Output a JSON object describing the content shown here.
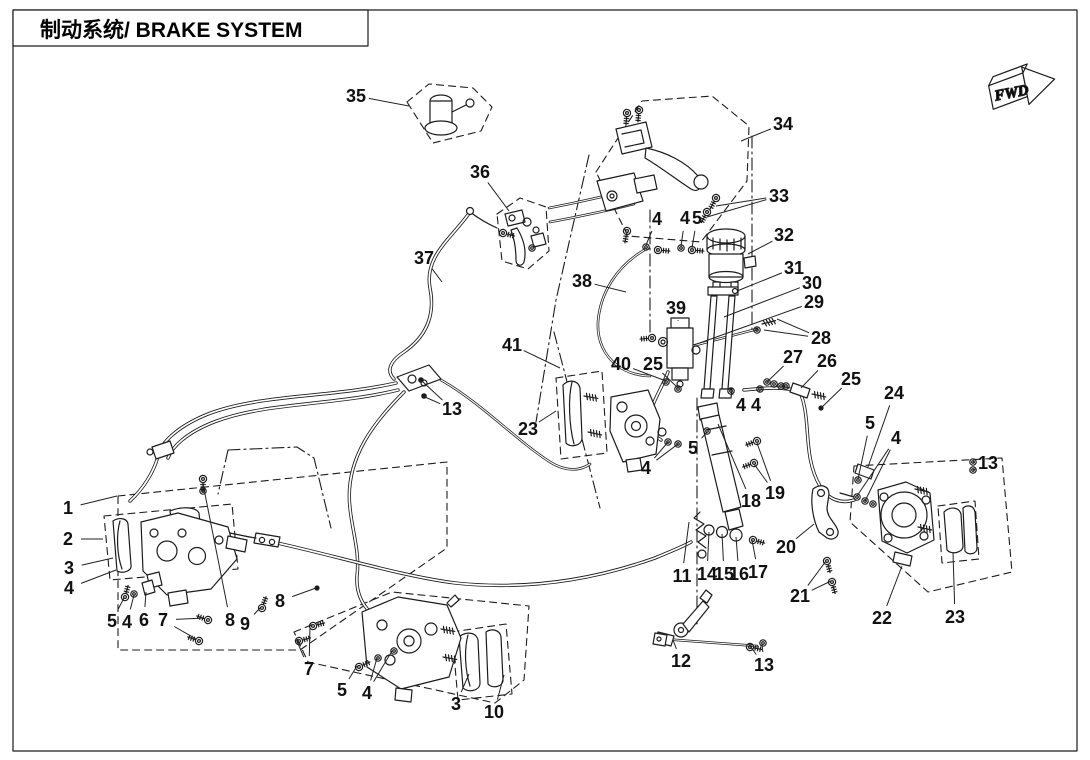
{
  "header": {
    "title": "制动系统/ BRAKE SYSTEM"
  },
  "fwd_marker": {
    "label": "FWD"
  },
  "diagram": {
    "callouts": [
      {
        "n": "35",
        "x": 356,
        "y": 96,
        "l": [
          [
            409,
            106
          ]
        ]
      },
      {
        "n": "36",
        "x": 480,
        "y": 172,
        "l": [
          [
            509,
            211
          ]
        ]
      },
      {
        "n": "37",
        "x": 424,
        "y": 258,
        "l": [
          [
            442,
            282
          ]
        ]
      },
      {
        "n": "34",
        "x": 783,
        "y": 124,
        "l": [
          [
            741,
            141
          ]
        ]
      },
      {
        "n": "33",
        "x": 779,
        "y": 196,
        "l": [
          [
            716,
            206
          ],
          [
            707,
            217
          ]
        ]
      },
      {
        "n": "32",
        "x": 784,
        "y": 235,
        "l": [
          [
            748,
            254
          ]
        ]
      },
      {
        "n": "31",
        "x": 794,
        "y": 268,
        "l": [
          [
            737,
            291
          ]
        ]
      },
      {
        "n": "30",
        "x": 812,
        "y": 283,
        "l": [
          [
            724,
            317
          ]
        ]
      },
      {
        "n": "29",
        "x": 814,
        "y": 302,
        "l": [
          [
            694,
            345
          ]
        ]
      },
      {
        "n": "28",
        "x": 821,
        "y": 338,
        "l": [
          [
            777,
            319
          ],
          [
            764,
            330
          ]
        ]
      },
      {
        "n": "39",
        "x": 676,
        "y": 308,
        "l": [
          [
            678,
            320
          ]
        ]
      },
      {
        "n": "38",
        "x": 582,
        "y": 281,
        "l": [
          [
            626,
            292
          ]
        ]
      },
      {
        "n": "40",
        "x": 621,
        "y": 364,
        "l": [
          [
            666,
            381
          ]
        ]
      },
      {
        "n": "25",
        "x": 653,
        "y": 364,
        "l": [
          [
            678,
            388
          ]
        ]
      },
      {
        "n": "41",
        "x": 512,
        "y": 345,
        "l": [
          [
            560,
            368
          ]
        ]
      },
      {
        "n": "4",
        "x": 657,
        "y": 219,
        "l": [
          [
            646,
            245
          ]
        ]
      },
      {
        "n": "4",
        "x": 685,
        "y": 218,
        "l": [
          [
            681,
            246
          ]
        ]
      },
      {
        "n": "5",
        "x": 697,
        "y": 218,
        "l": [
          [
            692,
            248
          ]
        ]
      },
      {
        "n": "23",
        "x": 528,
        "y": 429,
        "l": [
          [
            556,
            411
          ]
        ]
      },
      {
        "n": "4",
        "x": 646,
        "y": 468,
        "l": [
          [
            668,
            442
          ],
          [
            678,
            444
          ]
        ]
      },
      {
        "n": "5",
        "x": 693,
        "y": 448,
        "l": [
          [
            707,
            432
          ]
        ]
      },
      {
        "n": "18",
        "x": 751,
        "y": 501,
        "l": [
          [
            718,
            424
          ]
        ]
      },
      {
        "n": "19",
        "x": 775,
        "y": 493,
        "l": [
          [
            757,
            443
          ],
          [
            754,
            464
          ]
        ]
      },
      {
        "n": "4",
        "x": 741,
        "y": 405,
        "l": [
          [
            731,
            392
          ]
        ]
      },
      {
        "n": "4",
        "x": 756,
        "y": 405,
        "l": [
          [
            760,
            390
          ]
        ]
      },
      {
        "n": "27",
        "x": 793,
        "y": 357,
        "l": [
          [
            767,
            382
          ]
        ]
      },
      {
        "n": "26",
        "x": 827,
        "y": 361,
        "l": [
          [
            801,
            388
          ]
        ]
      },
      {
        "n": "25",
        "x": 851,
        "y": 379,
        "l": [
          [
            821,
            408
          ]
        ]
      },
      {
        "n": "24",
        "x": 894,
        "y": 393,
        "l": [
          [
            868,
            467
          ]
        ]
      },
      {
        "n": "5",
        "x": 870,
        "y": 423,
        "l": [
          [
            858,
            479
          ]
        ]
      },
      {
        "n": "4",
        "x": 896,
        "y": 438,
        "l": [
          [
            857,
            496
          ],
          [
            865,
            501
          ]
        ]
      },
      {
        "n": "13",
        "x": 988,
        "y": 463,
        "l": [
          [
            973,
            462
          ],
          [
            973,
            470
          ]
        ]
      },
      {
        "n": "20",
        "x": 786,
        "y": 547,
        "l": [
          [
            814,
            524
          ]
        ]
      },
      {
        "n": "21",
        "x": 800,
        "y": 596,
        "l": [
          [
            826,
            561
          ],
          [
            831,
            581
          ]
        ]
      },
      {
        "n": "22",
        "x": 882,
        "y": 618,
        "l": [
          [
            902,
            566
          ]
        ]
      },
      {
        "n": "23",
        "x": 955,
        "y": 617,
        "l": [
          [
            953,
            553
          ]
        ]
      },
      {
        "n": "11",
        "x": 682,
        "y": 576,
        "l": [
          [
            689,
            522
          ]
        ]
      },
      {
        "n": "14",
        "x": 707,
        "y": 574,
        "l": [
          [
            709,
            532
          ]
        ]
      },
      {
        "n": "15",
        "x": 724,
        "y": 574,
        "l": [
          [
            722,
            534
          ]
        ]
      },
      {
        "n": "16",
        "x": 739,
        "y": 574,
        "l": [
          [
            736,
            537
          ]
        ]
      },
      {
        "n": "17",
        "x": 758,
        "y": 572,
        "l": [
          [
            752,
            540
          ]
        ]
      },
      {
        "n": "12",
        "x": 681,
        "y": 661,
        "l": [
          [
            673,
            640
          ]
        ]
      },
      {
        "n": "13",
        "x": 764,
        "y": 665,
        "l": [
          [
            750,
            646
          ],
          [
            762,
            644
          ]
        ]
      },
      {
        "n": "1",
        "x": 68,
        "y": 508,
        "l": [
          [
            117,
            496
          ]
        ]
      },
      {
        "n": "2",
        "x": 68,
        "y": 539,
        "l": [
          [
            103,
            539
          ]
        ]
      },
      {
        "n": "3",
        "x": 69,
        "y": 568,
        "l": [
          [
            113,
            558
          ]
        ]
      },
      {
        "n": "4",
        "x": 69,
        "y": 588,
        "l": [
          [
            116,
            570
          ]
        ]
      },
      {
        "n": "5",
        "x": 112,
        "y": 621,
        "l": [
          [
            124,
            598
          ]
        ]
      },
      {
        "n": "4",
        "x": 127,
        "y": 622,
        "l": [
          [
            134,
            595
          ]
        ]
      },
      {
        "n": "6",
        "x": 144,
        "y": 620,
        "l": [
          [
            146,
            592
          ]
        ]
      },
      {
        "n": "7",
        "x": 163,
        "y": 620,
        "l": [
          [
            204,
            618
          ],
          [
            196,
            639
          ]
        ]
      },
      {
        "n": "8",
        "x": 230,
        "y": 620,
        "l": [
          [
            203,
            484
          ]
        ]
      },
      {
        "n": "9",
        "x": 245,
        "y": 624,
        "l": [
          [
            261,
            607
          ]
        ]
      },
      {
        "n": "8",
        "x": 280,
        "y": 601,
        "l": [
          [
            316,
            588
          ]
        ]
      },
      {
        "n": "7",
        "x": 309,
        "y": 669,
        "l": [
          [
            310,
            626
          ],
          [
            296,
            639
          ]
        ]
      },
      {
        "n": "5",
        "x": 342,
        "y": 690,
        "l": [
          [
            357,
            666
          ]
        ]
      },
      {
        "n": "4",
        "x": 367,
        "y": 693,
        "l": [
          [
            377,
            658
          ],
          [
            392,
            651
          ]
        ]
      },
      {
        "n": "3",
        "x": 456,
        "y": 704,
        "l": [
          [
            469,
            674
          ]
        ]
      },
      {
        "n": "10",
        "x": 494,
        "y": 712,
        "l": [
          [
            504,
            675
          ]
        ]
      },
      {
        "n": "13",
        "x": 452,
        "y": 409,
        "l": [
          [
            423,
            382
          ],
          [
            425,
            397
          ]
        ]
      }
    ]
  }
}
